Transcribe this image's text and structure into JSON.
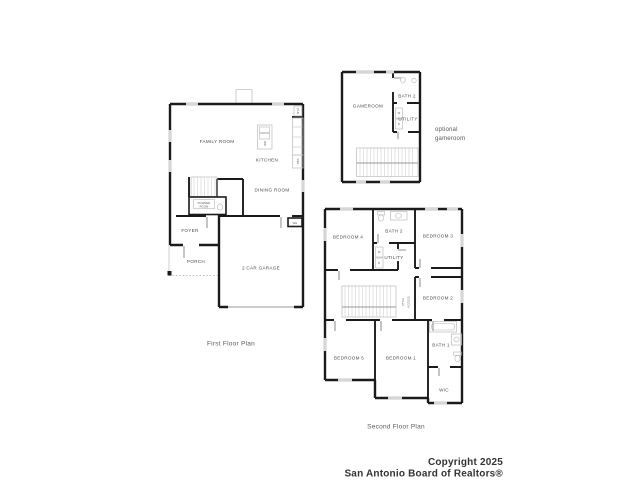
{
  "colors": {
    "background": "#ffffff",
    "wall": "#1b1b1b",
    "detail_gray": "#c3c3c3",
    "label_gray": "#4d4d4d",
    "title_gray": "#5a5a5a",
    "copyright": "#333333"
  },
  "ff": {
    "title": "First Floor Plan",
    "family_room": "FAMILY ROOM",
    "kitchen": "KITCHEN",
    "dining_room": "DINING ROOM",
    "powder_line1": "POWDER",
    "powder_line2": "ROOM",
    "foyer": "FOYER",
    "porch": "PORCH",
    "garage": "2 CAR GARAGE",
    "dishwasher": "DW",
    "refrigerator": "REF",
    "pantry": "PAN",
    "water_heater": "WH"
  },
  "og": {
    "gameroom": "GAMEROOM",
    "bath2": "BATH 2",
    "utility": "UTILITY",
    "washer": "W",
    "dryer": "D",
    "note_line1": "optional",
    "note_line2": "gameroom"
  },
  "sf": {
    "title": "Second Floor Plan",
    "bedroom4": "BEDROOM 4",
    "bath2": "BATH 2",
    "bedroom3": "BEDROOM 3",
    "utility": "UTILITY",
    "washer": "W",
    "dryer": "D",
    "attic_line1": "ATTIC",
    "attic_line2": "ACCESS",
    "bedroom2": "BEDROOM 2",
    "bedroom5": "BEDROOM 5",
    "bedroom1": "BEDROOM 1",
    "bath1": "BATH 1",
    "wic": "WIC"
  },
  "footer": {
    "line1": "Copyright 2025",
    "line2": "San Antonio Board of Realtors®"
  }
}
